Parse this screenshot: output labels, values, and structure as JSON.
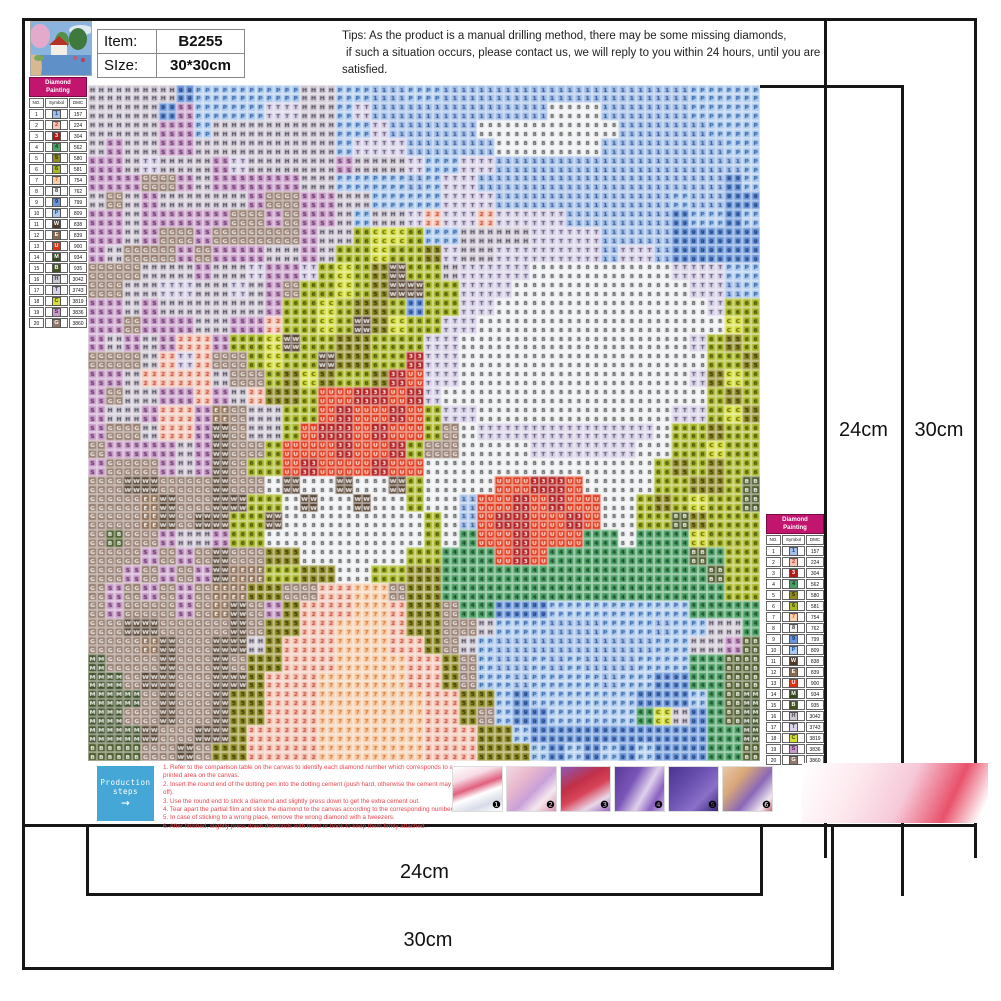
{
  "header": {
    "item_label": "Item:",
    "item_value": "B2255",
    "size_label": "SIze:",
    "size_value": "30*30cm",
    "tips_line1": "Tips: As the product is a manual drilling method, there may be some missing diamonds,",
    "tips_line2": "if such a situation occurs, please contact us, we will reply to you within 24 hours, until you are",
    "tips_line3": "satisfied."
  },
  "legend": {
    "title_line1": "Diamond",
    "title_line2": "Painting",
    "col_no": "NO.",
    "col_symbol": "Symbol",
    "col_dmc": "DMC",
    "rows": [
      {
        "no": "1",
        "symbol": "1",
        "dmc": "157"
      },
      {
        "no": "2",
        "symbol": "2",
        "dmc": "224"
      },
      {
        "no": "3",
        "symbol": "3",
        "dmc": "304"
      },
      {
        "no": "4",
        "symbol": "4",
        "dmc": "562"
      },
      {
        "no": "5",
        "symbol": "5",
        "dmc": "580"
      },
      {
        "no": "6",
        "symbol": "6",
        "dmc": "581"
      },
      {
        "no": "7",
        "symbol": "7",
        "dmc": "754"
      },
      {
        "no": "8",
        "symbol": "8",
        "dmc": "762"
      },
      {
        "no": "9",
        "symbol": "9",
        "dmc": "799"
      },
      {
        "no": "10",
        "symbol": "P",
        "dmc": "809"
      },
      {
        "no": "11",
        "symbol": "W",
        "dmc": "838"
      },
      {
        "no": "12",
        "symbol": "E",
        "dmc": "839"
      },
      {
        "no": "13",
        "symbol": "U",
        "dmc": "900"
      },
      {
        "no": "14",
        "symbol": "M",
        "dmc": "934"
      },
      {
        "no": "15",
        "symbol": "B",
        "dmc": "935"
      },
      {
        "no": "16",
        "symbol": "H",
        "dmc": "3042"
      },
      {
        "no": "17",
        "symbol": "T",
        "dmc": "3743"
      },
      {
        "no": "18",
        "symbol": "C",
        "dmc": "3819"
      },
      {
        "no": "19",
        "symbol": "S",
        "dmc": "3836"
      },
      {
        "no": "20",
        "symbol": "G",
        "dmc": "3860"
      }
    ]
  },
  "dimensions": {
    "right_inner": "24cm",
    "right_outer": "30cm",
    "bottom_inner": "24cm",
    "bottom_outer": "30cm"
  },
  "production": {
    "box_line1": "Production",
    "box_line2": "steps",
    "arrow": "→",
    "steps": [
      "1. Refer to the comparison table on the canvas to identify each diamond number which corresponds to a printed area on the canvas.",
      "2. Insert the round end of the dotting pen into the dotting cement (push hard, otherwise the cement may fall off).",
      "3. Use the round end to stick a diamond and slightly press down to get the extra cement out.",
      "4. Tear apart the partial film and stick the diamond to the canvas according to the corresponding number.",
      "5. In case of sticking to a wrong place, remove the wrong diamond with a tweezers.",
      "6. After finished, slightly press down diamonds with hand or book to keep them firmly attached."
    ],
    "photo_numbers": [
      "❶",
      "❷",
      "❸",
      "❹",
      "❺",
      "❻"
    ]
  },
  "canvas": {
    "cols": 76,
    "rows": 76,
    "palette": {
      "1": [
        "#a3bfe8",
        "#2a4a8a"
      ],
      "2": [
        "#f3c6b6",
        "#c23a2a"
      ],
      "3": [
        "#b01818",
        "#ffffff"
      ],
      "4": [
        "#4ba065",
        "#123a22"
      ],
      "5": [
        "#8f8b22",
        "#2a2a08"
      ],
      "6": [
        "#a9b823",
        "#333a08"
      ],
      "7": [
        "#f6cfae",
        "#d06a1e"
      ],
      "8": [
        "#eef0f2",
        "#444444"
      ],
      "9": [
        "#6a95d8",
        "#15306e"
      ],
      "P": [
        "#abc9ee",
        "#24589a"
      ],
      "W": [
        "#4f3a28",
        "#ffffff"
      ],
      "E": [
        "#8a6a4f",
        "#ffffff"
      ],
      "U": [
        "#e03212",
        "#ffffff"
      ],
      "M": [
        "#36481f",
        "#ffffff"
      ],
      "B": [
        "#42521e",
        "#ffffff"
      ],
      "H": [
        "#cdc7d2",
        "#4a4454"
      ],
      "T": [
        "#d9d2e8",
        "#564e6a"
      ],
      "C": [
        "#d5df3c",
        "#4a4a08"
      ],
      "S": [
        "#c89cc8",
        "#5a2a5a"
      ],
      "G": [
        "#92786a",
        "#ffffff"
      ]
    },
    "map": [
      "HHHHH9PPPPPPHHPP11PP11111111111111PPPP",
      "HHHH9SPPPPTTHHPT111111111188811111PPPP",
      "HHHHSSPHHHHHHHPPT111118888888811111PPP",
      "HSHHSSHHHHHHHHPTTT111118888881111111PP",
      "SSHTHHHSTHHHHHSHHHTPPTT11111111111111P",
      "SSSGGSHSSSSSHHPPPP1PTT111111111111119P",
      "HGHSHHHHHSGGSSHHPPPPTTT1111111111P1199",
      "SSHSSSSSGGSGSSHPHHT2TT2TTTT1111119PP9P",
      "SSHSGGSGGGGGSHH6CC6PPHHHHTTTT111199999",
      "SHGGGSGSSSHHSH66C665THHTTTTTT1TT199999",
      "GGGHHHSHHTSST6C65W66HTTTT88888888TTTPP",
      "GGHHTTHHTHSG66C65WW66TTT8888888888TT1P",
      "SSHSHHHHHHS66C6556966TT888888888888T66",
      "SSGSSSHHSS266C6W5C66TT88888888888888C6",
      "SHSHS22S66CW6655666TT8888888888888T656",
      "GGGH2T2GG6C66W55663TT88888888888888665",
      "SSH2222HGG65C56653UTT8888888888888T5C6",
      "SGHHSS2SH2556UU33U3T888888888888888656",
      "SHHS22SEGHH66U3UU3U6TT88888888888TT6C5",
      "SGGH22SWGHH6U33U3UU6G8TTTTTTTTTT866566",
      "GSSSSHSWGG6UUU3UU36GG8888TTTTTT8866C66",
      "SGGGSHSWG66U3UUU3UU8888888888888656566",
      "GGWWGGGWGG8W88W88W68888UU33U888866556B",
      "GGGEWGGWW668W88W886881UU3U3UU88656C66B",
      "GGGEWGWW66W88888888681U33UU3U8866B5666",
      "GBGGSHHS66888888888684UU3UUU448444C666",
      "GGGSGSGWGG5588888866444U3U44444444B466",
      "GGSGSGSWEE6655886655444444444444444B66",
      "GSGSGSGEE55GG2277G55444444444444444466",
      "GSGGGSGEWGS522277255G44999PPPPPPPP4444",
      "GGWWGGGGWG5522777255GGHPPP111PPP1PPHH4",
      "GGGEWGGWWH5222777225GHP111111111PPHHSB",
      "MGGGWGGWG552227777225GP11P1P111PPP44BB",
      "MMGWWGGWW522277777225GPP1PPPP1PP9944BB",
      "MMMGWGGW552227777772255P9PPPPPP999P4BM",
      "MMGGWGGW55222777777225GP99PPPPP4CH94BM",
      "MMMWGGWW5222277777722255P999999999944M",
      "BBBGGWG552222777777222555P9P9P9P99944B"
    ]
  }
}
